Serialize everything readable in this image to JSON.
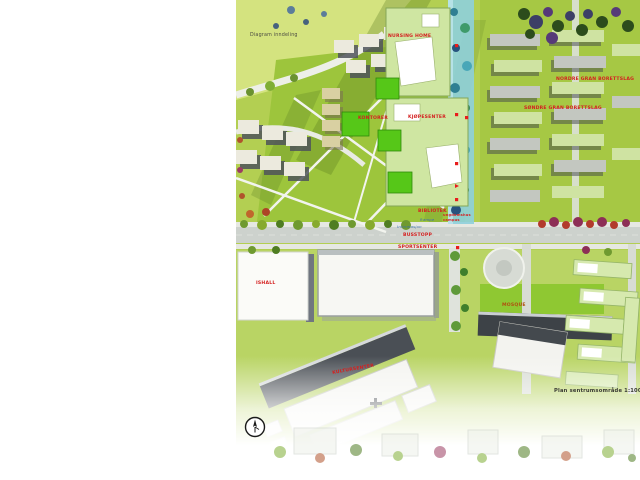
{
  "map": {
    "labels": {
      "diagram_note": "Diagram inndeling",
      "nursing_home": "NURSING HOME",
      "offices": "KONTORER",
      "shopping_center": "KJØPESENTER",
      "nordre_borettslag": "NORDRE GRAN BORETTSLAG",
      "sondre_borettslag": "SØNDRE GRAN BORETTSLAG",
      "library": "BIBLIOTEK",
      "youth_house_line1": "ungdomshus",
      "youth_house_line2": "campus",
      "ramp": "Rampe",
      "information": "Informasjon",
      "bus_stop": "BUSSTOPP",
      "sports_center": "SPORTSENTER",
      "ice_hall": "ISHALL",
      "mosque": "MOSQUE",
      "culture_center": "KULTURSENTER",
      "plan_caption": "Plan sentrumsområde 1:1000"
    },
    "colors": {
      "label_red": "#d42020",
      "label_orange": "#b05010",
      "grass": "#b3cf52",
      "water": "#8ecfdb",
      "new_block_green": "#cfe6a2",
      "bright_green": "#56c718",
      "road_gray": "#cdd2cd"
    },
    "icons": {
      "north_arrow": "north-arrow-icon"
    }
  }
}
